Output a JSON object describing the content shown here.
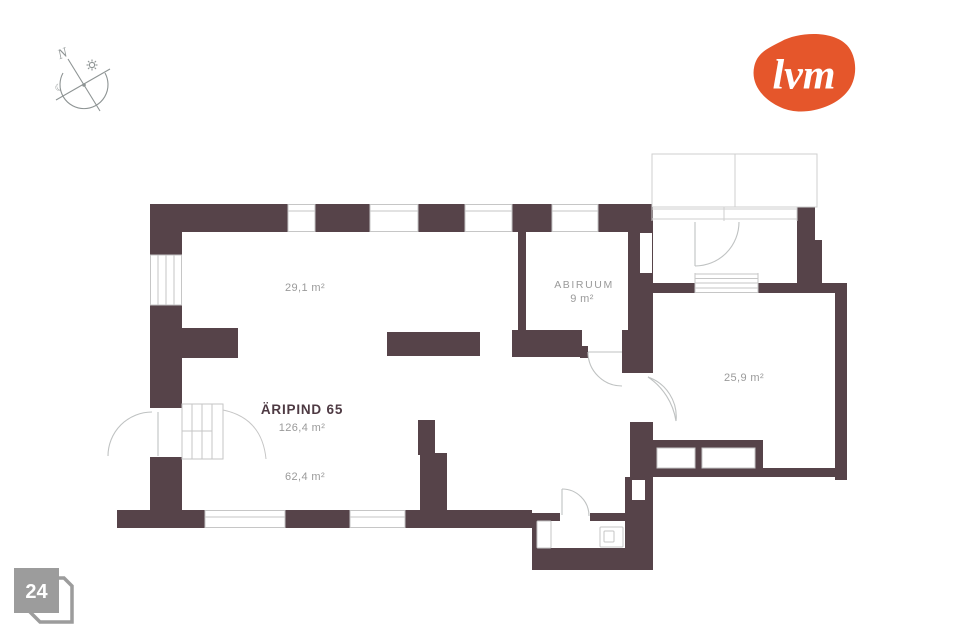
{
  "logo": {
    "text": "lvm",
    "color": "#e5562b"
  },
  "compass": {
    "north_label": "N"
  },
  "page_number": {
    "value": "24",
    "color": "#9c9c9c"
  },
  "floor_plan": {
    "wall_color": "#564349",
    "line_color": "#c6c6c6",
    "label_color": "#9a9a9a",
    "title_color": "#4e3a43",
    "rooms": [
      {
        "id": "room-291",
        "area_label": "29,1 m²"
      },
      {
        "id": "abiruum",
        "name": "ABIRUUM",
        "area_label": "9 m²"
      },
      {
        "id": "aripind",
        "name": "ÄRIPIND 65",
        "area_label": "126,4 m²"
      },
      {
        "id": "room-624",
        "area_label": "62,4 m²"
      },
      {
        "id": "room-259",
        "area_label": "25,9 m²"
      }
    ]
  }
}
